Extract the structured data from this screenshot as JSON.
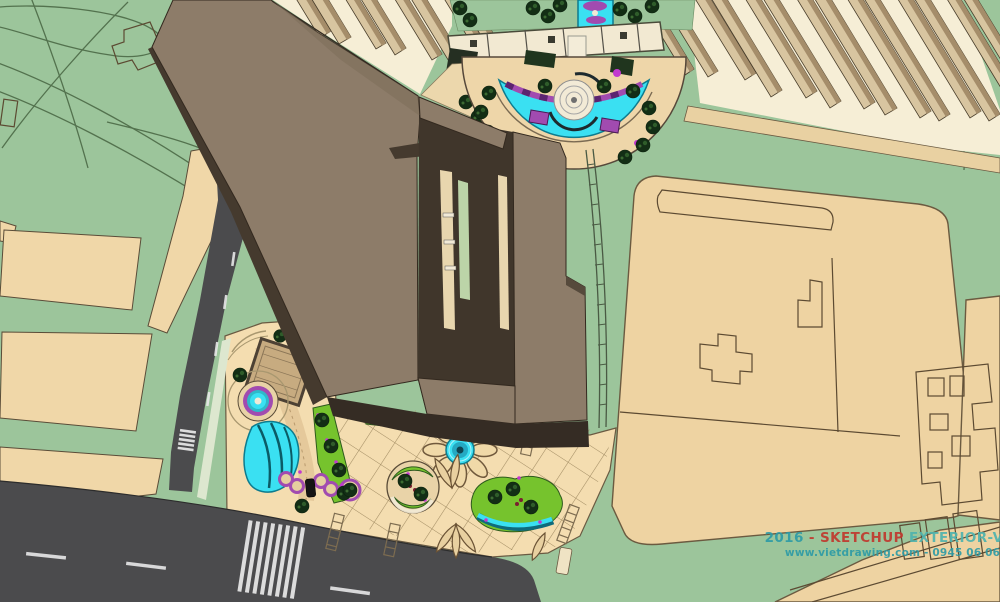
{
  "watermark": {
    "line1": {
      "year": "2016",
      "separator": " - ",
      "brand": "SKETCHUP",
      "rest": " EXTERIOR-VOL.6"
    },
    "line2": "www.vietdrawing.com - 0945 06 06 08"
  },
  "colors": {
    "grass": "#9cc59b",
    "roofTan": "#f0d7a8",
    "lotTan": "#eed3a2",
    "plazaTan": "#f4ddb0",
    "creamBase": "#f6eed6",
    "towerFace": "#d8c5a0",
    "towerSide": "#a58d6a",
    "roofLight": "#8d7c69",
    "roofMid": "#7e6d5a",
    "roofDark": "#453a2e",
    "roofDarkest": "#352c24",
    "road": "#4b4b4d",
    "roadMarking": "#e9e9e9",
    "water": "#3ae0f2",
    "waterDeep": "#17b9d8",
    "purple": "#a14bb0",
    "magenta": "#c23ad0",
    "plantBright": "#76c32d",
    "treeDark": "#132e15",
    "pathBrick": "#e5c99b",
    "outline": "#5a4c38",
    "watermarkTeal": "#2e9ba6",
    "watermarkTealLight": "#4fb3ae",
    "watermarkRed": "#c0392e"
  }
}
